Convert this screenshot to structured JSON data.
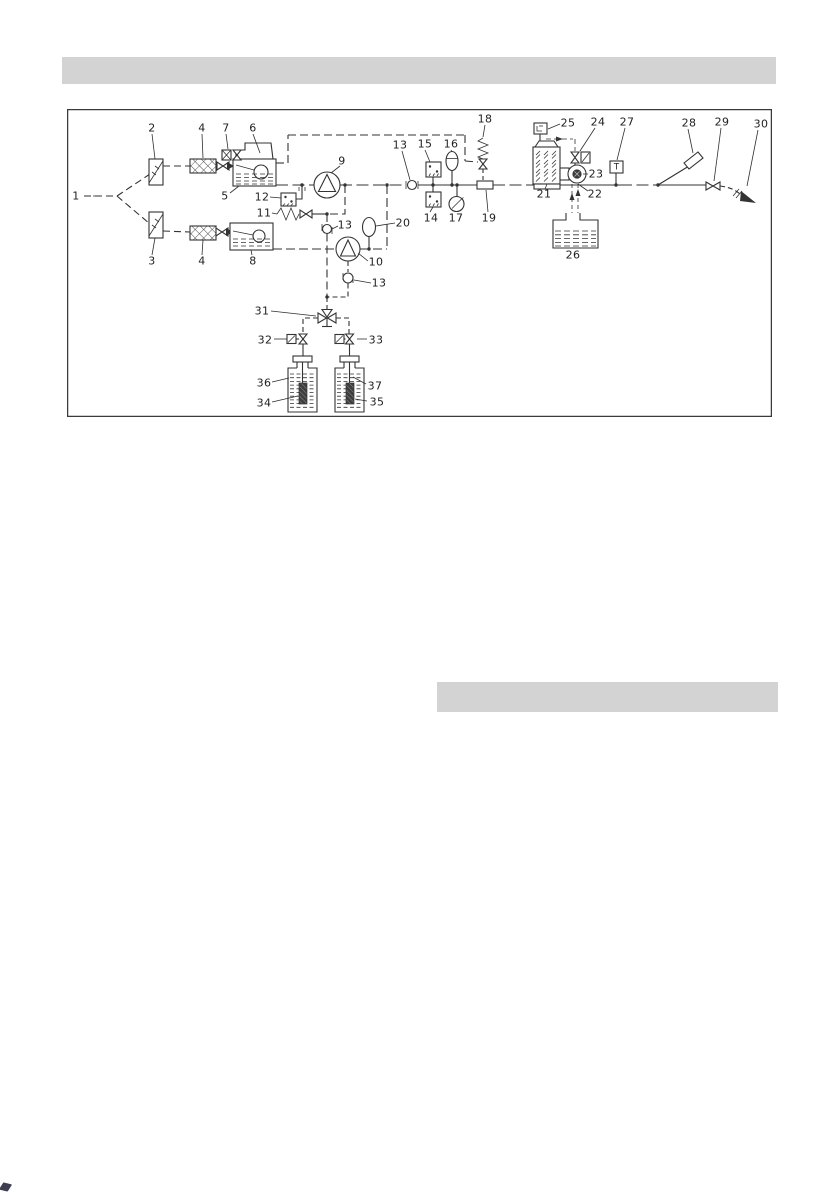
{
  "page": {
    "background_color": "#ffffff",
    "top_section_bar": {
      "text": "",
      "color": "#d3d3d3"
    },
    "mid_section_bar": {
      "text": "",
      "color": "#d3d3d3"
    },
    "corner_mark_color": "#1c1c33"
  },
  "diagram": {
    "type": "schematic",
    "border_color": "#3a3a3a",
    "line_color": "#333333",
    "label_color": "#1f1f1f",
    "labels": [
      {
        "t": "1",
        "x": 76,
        "y": 196
      },
      {
        "t": "2",
        "x": 152,
        "y": 128
      },
      {
        "t": "4",
        "x": 202,
        "y": 128
      },
      {
        "t": "7",
        "x": 226,
        "y": 128
      },
      {
        "t": "6",
        "x": 253,
        "y": 128
      },
      {
        "t": "3",
        "x": 152,
        "y": 261
      },
      {
        "t": "4",
        "x": 202,
        "y": 261
      },
      {
        "t": "8",
        "x": 253,
        "y": 261
      },
      {
        "t": "5",
        "x": 225,
        "y": 196
      },
      {
        "t": "12",
        "x": 262,
        "y": 197
      },
      {
        "t": "11",
        "x": 264,
        "y": 213
      },
      {
        "t": "9",
        "x": 342,
        "y": 161
      },
      {
        "t": "13",
        "x": 400,
        "y": 145
      },
      {
        "t": "15",
        "x": 425,
        "y": 144
      },
      {
        "t": "16",
        "x": 451,
        "y": 144
      },
      {
        "t": "18",
        "x": 485,
        "y": 119
      },
      {
        "t": "14",
        "x": 431,
        "y": 218
      },
      {
        "t": "17",
        "x": 456,
        "y": 218
      },
      {
        "t": "19",
        "x": 489,
        "y": 218
      },
      {
        "t": "13",
        "x": 345,
        "y": 225
      },
      {
        "t": "20",
        "x": 403,
        "y": 223
      },
      {
        "t": "10",
        "x": 376,
        "y": 262
      },
      {
        "t": "13",
        "x": 379,
        "y": 283
      },
      {
        "t": "25",
        "x": 568,
        "y": 123
      },
      {
        "t": "24",
        "x": 598,
        "y": 122
      },
      {
        "t": "27",
        "x": 627,
        "y": 122
      },
      {
        "t": "21",
        "x": 544,
        "y": 194
      },
      {
        "t": "23",
        "x": 596,
        "y": 174
      },
      {
        "t": "22",
        "x": 595,
        "y": 194
      },
      {
        "t": "26",
        "x": 573,
        "y": 255
      },
      {
        "t": "28",
        "x": 689,
        "y": 123
      },
      {
        "t": "29",
        "x": 722,
        "y": 122
      },
      {
        "t": "30",
        "x": 761,
        "y": 124
      },
      {
        "t": "31",
        "x": 262,
        "y": 311
      },
      {
        "t": "32",
        "x": 265,
        "y": 340
      },
      {
        "t": "33",
        "x": 376,
        "y": 340
      },
      {
        "t": "36",
        "x": 264,
        "y": 383
      },
      {
        "t": "34",
        "x": 264,
        "y": 403
      },
      {
        "t": "37",
        "x": 375,
        "y": 386
      },
      {
        "t": "35",
        "x": 377,
        "y": 402
      },
      {
        "t": "T",
        "x": 616.5,
        "y": 167.5,
        "small": true
      }
    ]
  }
}
